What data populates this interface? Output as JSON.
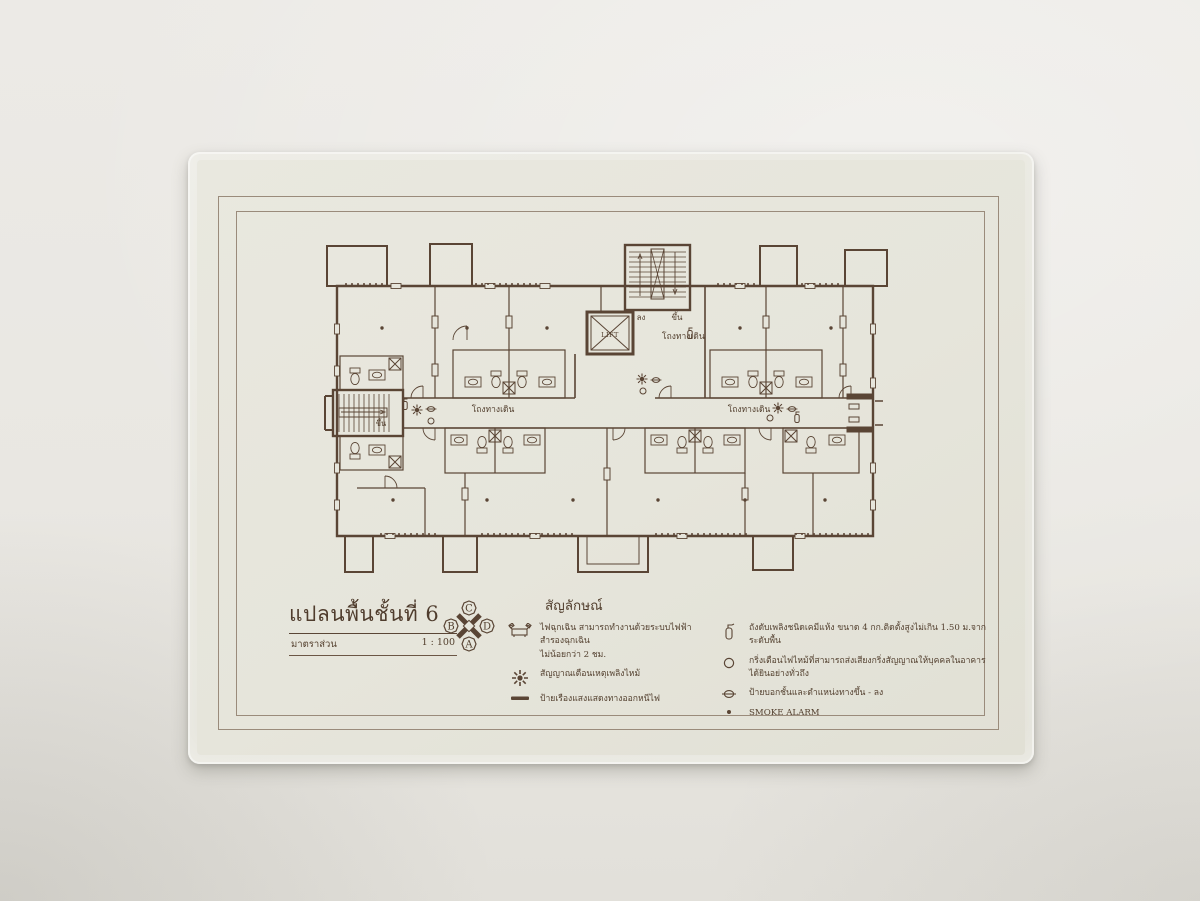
{
  "document": {
    "title": "แปลนพื้นชั้นที่ 6",
    "scale_label": "มาตราส่วน",
    "scale_value": "1 : 100"
  },
  "compass": {
    "top": "C",
    "left": "B",
    "right": "D",
    "bottom": "A"
  },
  "plan": {
    "labels": {
      "lift": "LIFT",
      "stair_down": "ลง",
      "stair_up": "ขึ้น",
      "left_stair_up": "ขึ้น",
      "corridor_center": "โถงทางเดิน",
      "corridor_left": "โถงทางเดิน",
      "corridor_right": "โถงทางเดิน"
    }
  },
  "legend": {
    "heading": "สัญลักษณ์",
    "left_items": [
      {
        "icon": "emergency-light-icon",
        "text": "ไฟฉุกเฉิน สามารถทำงานด้วยระบบไฟฟ้าสำรองฉุกเฉิน",
        "text2": "ไม่น้อยกว่า 2 ชม."
      },
      {
        "icon": "fire-alarm-signal-icon",
        "text": "สัญญาณเตือนเหตุเพลิงไหม้"
      },
      {
        "icon": "exit-glow-sign-icon",
        "text": "ป้ายเรืองแสงแสดงทางออกหนีไฟ"
      }
    ],
    "right_items": [
      {
        "icon": "fire-extinguisher-icon",
        "text": "ถังดับเพลิงชนิดเคมีแห้ง ขนาด 4 กก.ติดตั้งสูงไม่เกิน 1.50 ม.จากระดับพื้น"
      },
      {
        "icon": "alarm-bell-icon",
        "text": "กริ่งเตือนไฟไหม้ที่สามารถส่งเสียงกริ่งสัญญาณให้บุคคลในอาคารได้ยินอย่างทั่วถึง"
      },
      {
        "icon": "floor-direction-sign-icon",
        "text": "ป้ายบอกชั้นและตำแหน่งทางขึ้น - ลง"
      },
      {
        "icon": "smoke-alarm-dot-icon",
        "text": "SMOKE ALARM"
      }
    ]
  },
  "colors": {
    "ink": "#5a4535",
    "paper": "#e6e5db",
    "wall": "#e9e8e3"
  }
}
